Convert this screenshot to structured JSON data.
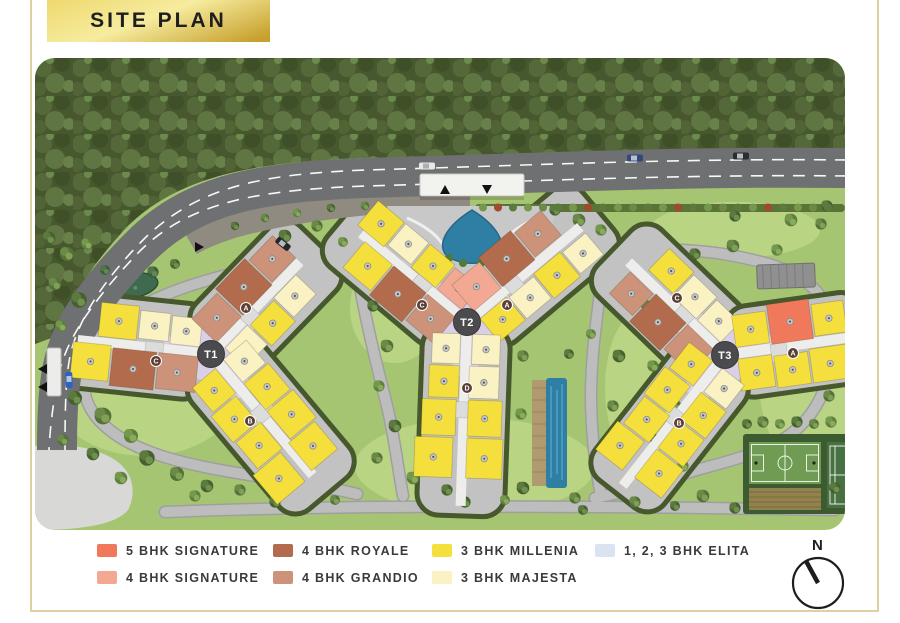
{
  "header": {
    "title": "SITE PLAN"
  },
  "compass": {
    "label": "N"
  },
  "towers": {
    "t1": "T1",
    "t2": "T2",
    "t3": "T3"
  },
  "unit_badges": {
    "a": "A",
    "b": "B",
    "c": "C",
    "d": "D"
  },
  "legend": {
    "items": [
      {
        "label": "5 BHK SIGNATURE",
        "color": "#F0795B",
        "key": "signature5"
      },
      {
        "label": "4 BHK SIGNATURE",
        "color": "#F2A893",
        "key": "signature4"
      },
      {
        "label": "4 BHK ROYALE",
        "color": "#B26C4D",
        "key": "royale"
      },
      {
        "label": "4 BHK GRANDIO",
        "color": "#CC937A",
        "key": "grandio"
      },
      {
        "label": "3 BHK MILLENIA",
        "color": "#F5DF3C",
        "key": "millenia"
      },
      {
        "label": "3 BHK MAJESTA",
        "color": "#FAF2C2",
        "key": "majesta"
      },
      {
        "label": "1, 2, 3 BHK ELITA",
        "color": "#DAE3F0",
        "key": "elita"
      }
    ]
  },
  "colors": {
    "signature5": "#F0795B",
    "signature4": "#F2A893",
    "royale": "#B26C4D",
    "grandio": "#CC937A",
    "millenia": "#F5DF3C",
    "majesta": "#FAF2C2",
    "elita": "#DAE3F0",
    "plaza": "#D9D0E8",
    "gold_light": "#F6EC9F",
    "gold_mid": "#EED96E",
    "gold_dark": "#C79F2C",
    "frame": "#DDD1A0"
  }
}
